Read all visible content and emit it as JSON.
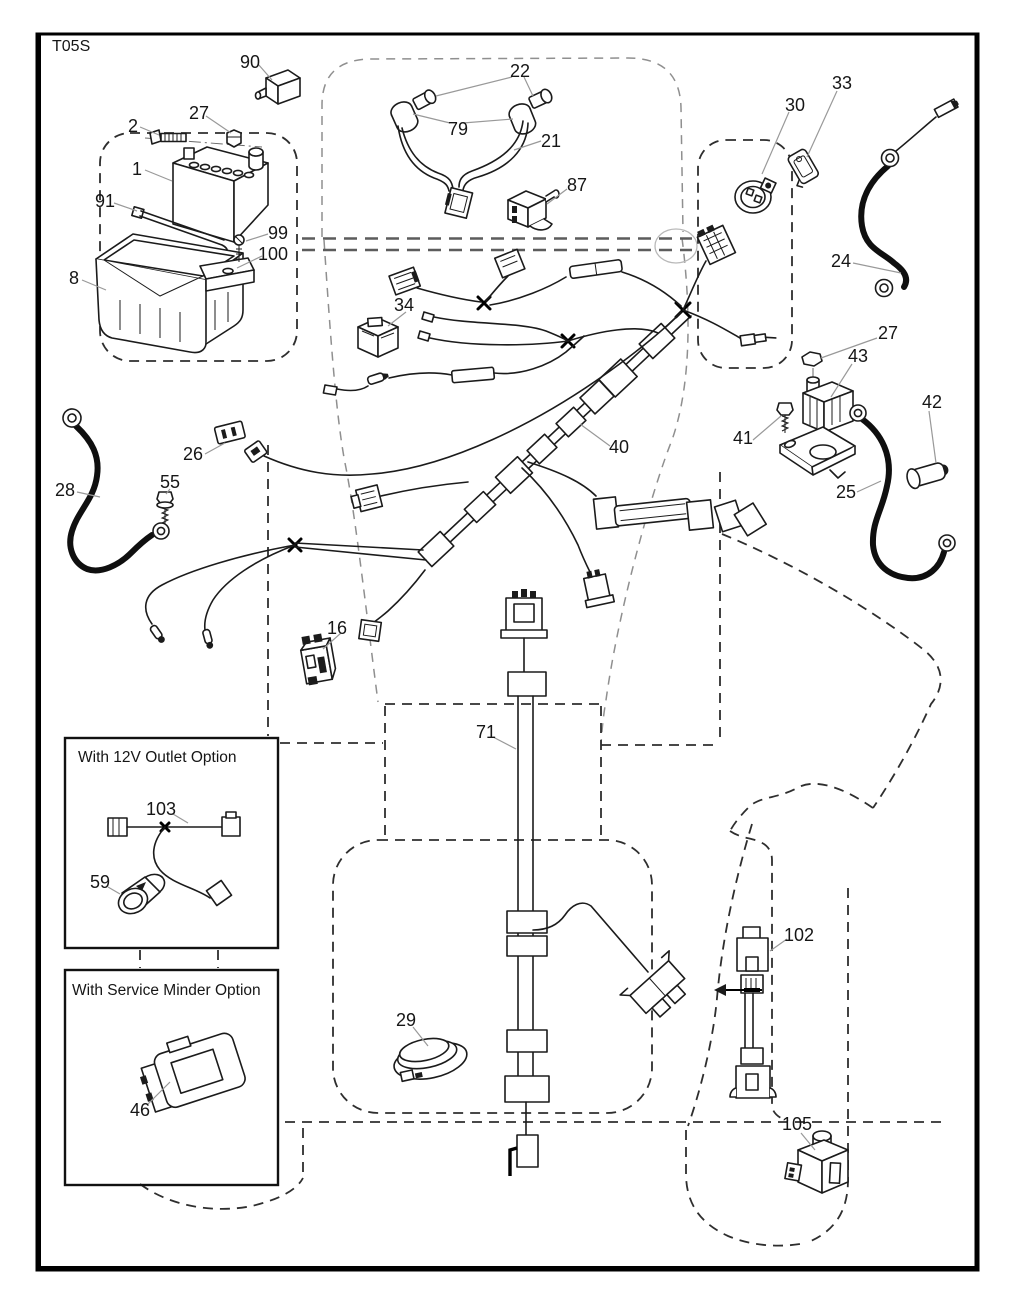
{
  "diagram": {
    "code": "T05S",
    "ink_color": "#1b1b1b",
    "paper_color": "#ffffff",
    "parts": {
      "p1": "1",
      "p2": "2",
      "p8": "8",
      "p16": "16",
      "p21": "21",
      "p22": "22",
      "p24": "24",
      "p25": "25",
      "p26": "26",
      "p27": "27",
      "p28": "28",
      "p29": "29",
      "p30": "30",
      "p33": "33",
      "p34": "34",
      "p40": "40",
      "p41": "41",
      "p42": "42",
      "p43": "43",
      "p46": "46",
      "p55": "55",
      "p59": "59",
      "p71": "71",
      "p79": "79",
      "p87": "87",
      "p90": "90",
      "p91": "91",
      "p99": "99",
      "p100": "100",
      "p102": "102",
      "p103": "103",
      "p105": "105"
    },
    "insets": {
      "outlet_title": "With 12V Outlet Option",
      "service_title": "With Service Minder Option"
    }
  }
}
